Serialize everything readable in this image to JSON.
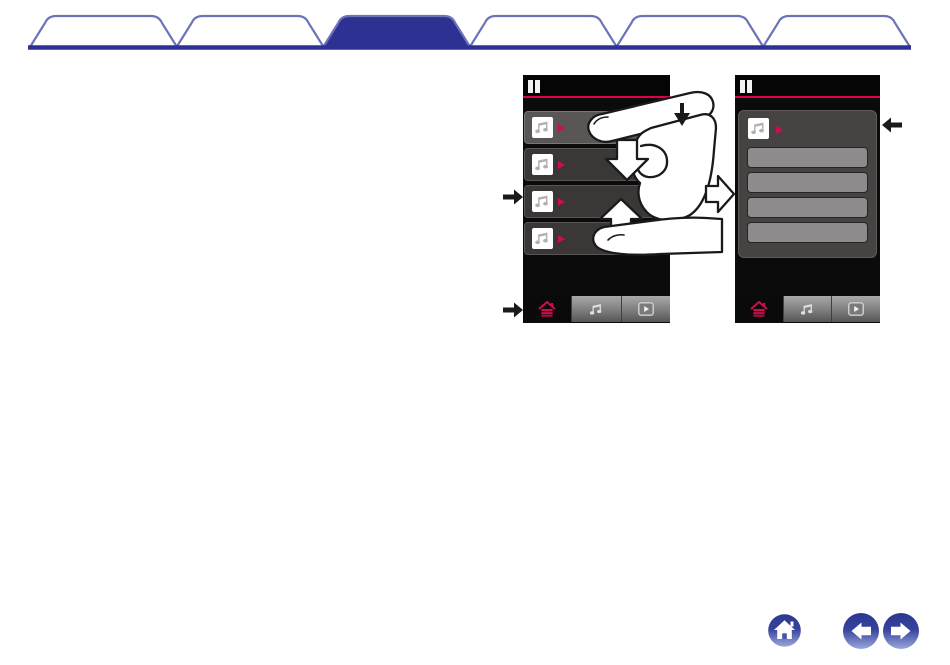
{
  "page": {
    "background": "#ffffff"
  },
  "chapter_tabs": {
    "count": 6,
    "active_index": 2,
    "outline_color": "#6b74b9",
    "active_fill": "#2e3192",
    "baseline_color": "#2b3293",
    "items": [
      {
        "id": "tab-1",
        "active": false
      },
      {
        "id": "tab-2",
        "active": false
      },
      {
        "id": "tab-3",
        "active": true
      },
      {
        "id": "tab-4",
        "active": false
      },
      {
        "id": "tab-5",
        "active": false
      },
      {
        "id": "tab-6",
        "active": false
      }
    ]
  },
  "figure": {
    "description_icons": [
      "pause-icon",
      "music-note-icon",
      "play-triangle-icon",
      "home-icon",
      "play-icon"
    ],
    "accent_color": "#e0004f",
    "before_screen": {
      "header": {
        "icon": "pause-icon"
      },
      "list_items": [
        {
          "icon": "music-note-icon",
          "marker": "play-triangle",
          "highlighted": true
        },
        {
          "icon": "music-note-icon",
          "marker": "play-triangle",
          "highlighted": false
        },
        {
          "icon": "music-note-icon",
          "marker": "play-triangle",
          "highlighted": false
        },
        {
          "icon": "music-note-icon",
          "marker": "play-triangle",
          "highlighted": false
        }
      ],
      "tab_bar": [
        {
          "icon": "home-icon",
          "active": true,
          "icon_color": "#d40a50"
        },
        {
          "icon": "music-note-icon",
          "active": false
        },
        {
          "icon": "play-icon",
          "active": false
        }
      ]
    },
    "after_screen": {
      "header": {
        "icon": "pause-icon"
      },
      "selected_item": {
        "icon": "music-note-icon",
        "marker": "play-triangle"
      },
      "empty_rows": 4,
      "tab_bar": [
        {
          "icon": "home-icon",
          "active": true,
          "icon_color": "#d40a50"
        },
        {
          "icon": "music-note-icon",
          "active": false
        },
        {
          "icon": "play-icon",
          "active": false
        }
      ]
    },
    "annotations": {
      "gesture": "vertical-swipe-with-finger",
      "arrows": [
        "tap-point-down-arrow",
        "swipe-down-block-arrow",
        "swipe-up-block-arrow",
        "screen-transition-right-arrow",
        "callout-arrow-list-item",
        "callout-arrow-tab-bar",
        "callout-arrow-selected-item"
      ]
    }
  },
  "nav_footer": {
    "buttons": [
      {
        "name": "home",
        "title": "home"
      },
      {
        "name": "back",
        "title": "back"
      },
      {
        "name": "forward",
        "title": "forward"
      }
    ],
    "gradient_top": "#2c3792",
    "gradient_bottom": "#9aa7dc"
  }
}
